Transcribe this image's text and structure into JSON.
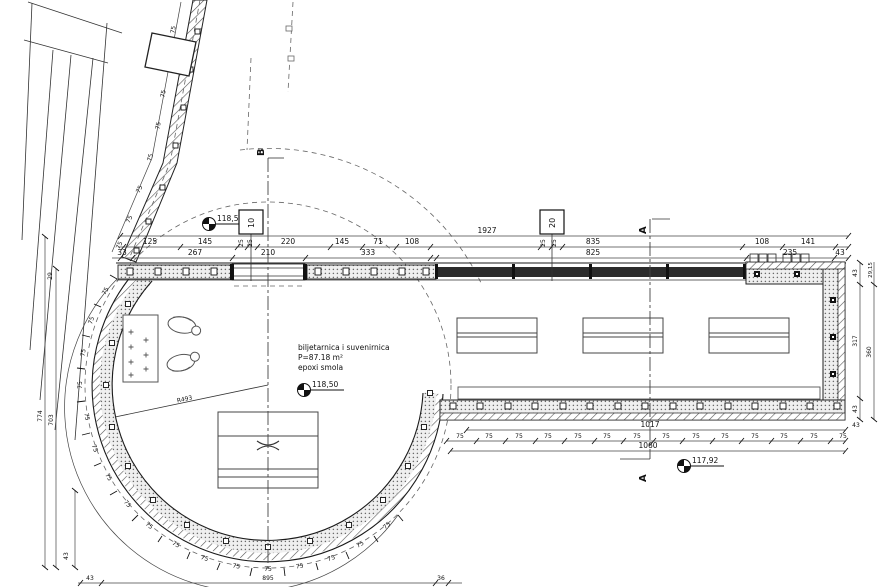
{
  "drawing": {
    "type": "architectural floor plan",
    "room": {
      "name": "biljetarnica i suvenirnica",
      "area": "P=87.18 m²",
      "floor": "epoxi smola"
    },
    "levels": {
      "l1": "118,50",
      "l2": "118,50",
      "l3": "117,92"
    },
    "markers": {
      "section_a": "A",
      "section_b": "B",
      "grid_10": "10",
      "grid_20": "20"
    },
    "radius": {
      "r1": "R493"
    },
    "d": {
      "n75": "75",
      "n43": "43",
      "n1927": "1927",
      "n125": "125",
      "n145": "145",
      "n25": "25",
      "n220": "220",
      "n71": "71",
      "n108": "108",
      "n835": "835",
      "n141": "141",
      "n33": "33",
      "n267": "267",
      "n210": "210",
      "n333": "333",
      "n825": "825",
      "n235": "235",
      "n1017": "1017",
      "n1060": "1060",
      "n774": "774",
      "n703": "703",
      "n29": "29",
      "n895": "895",
      "n36": "36",
      "n317": "317",
      "n360": "360",
      "n2915": "29,15"
    }
  }
}
